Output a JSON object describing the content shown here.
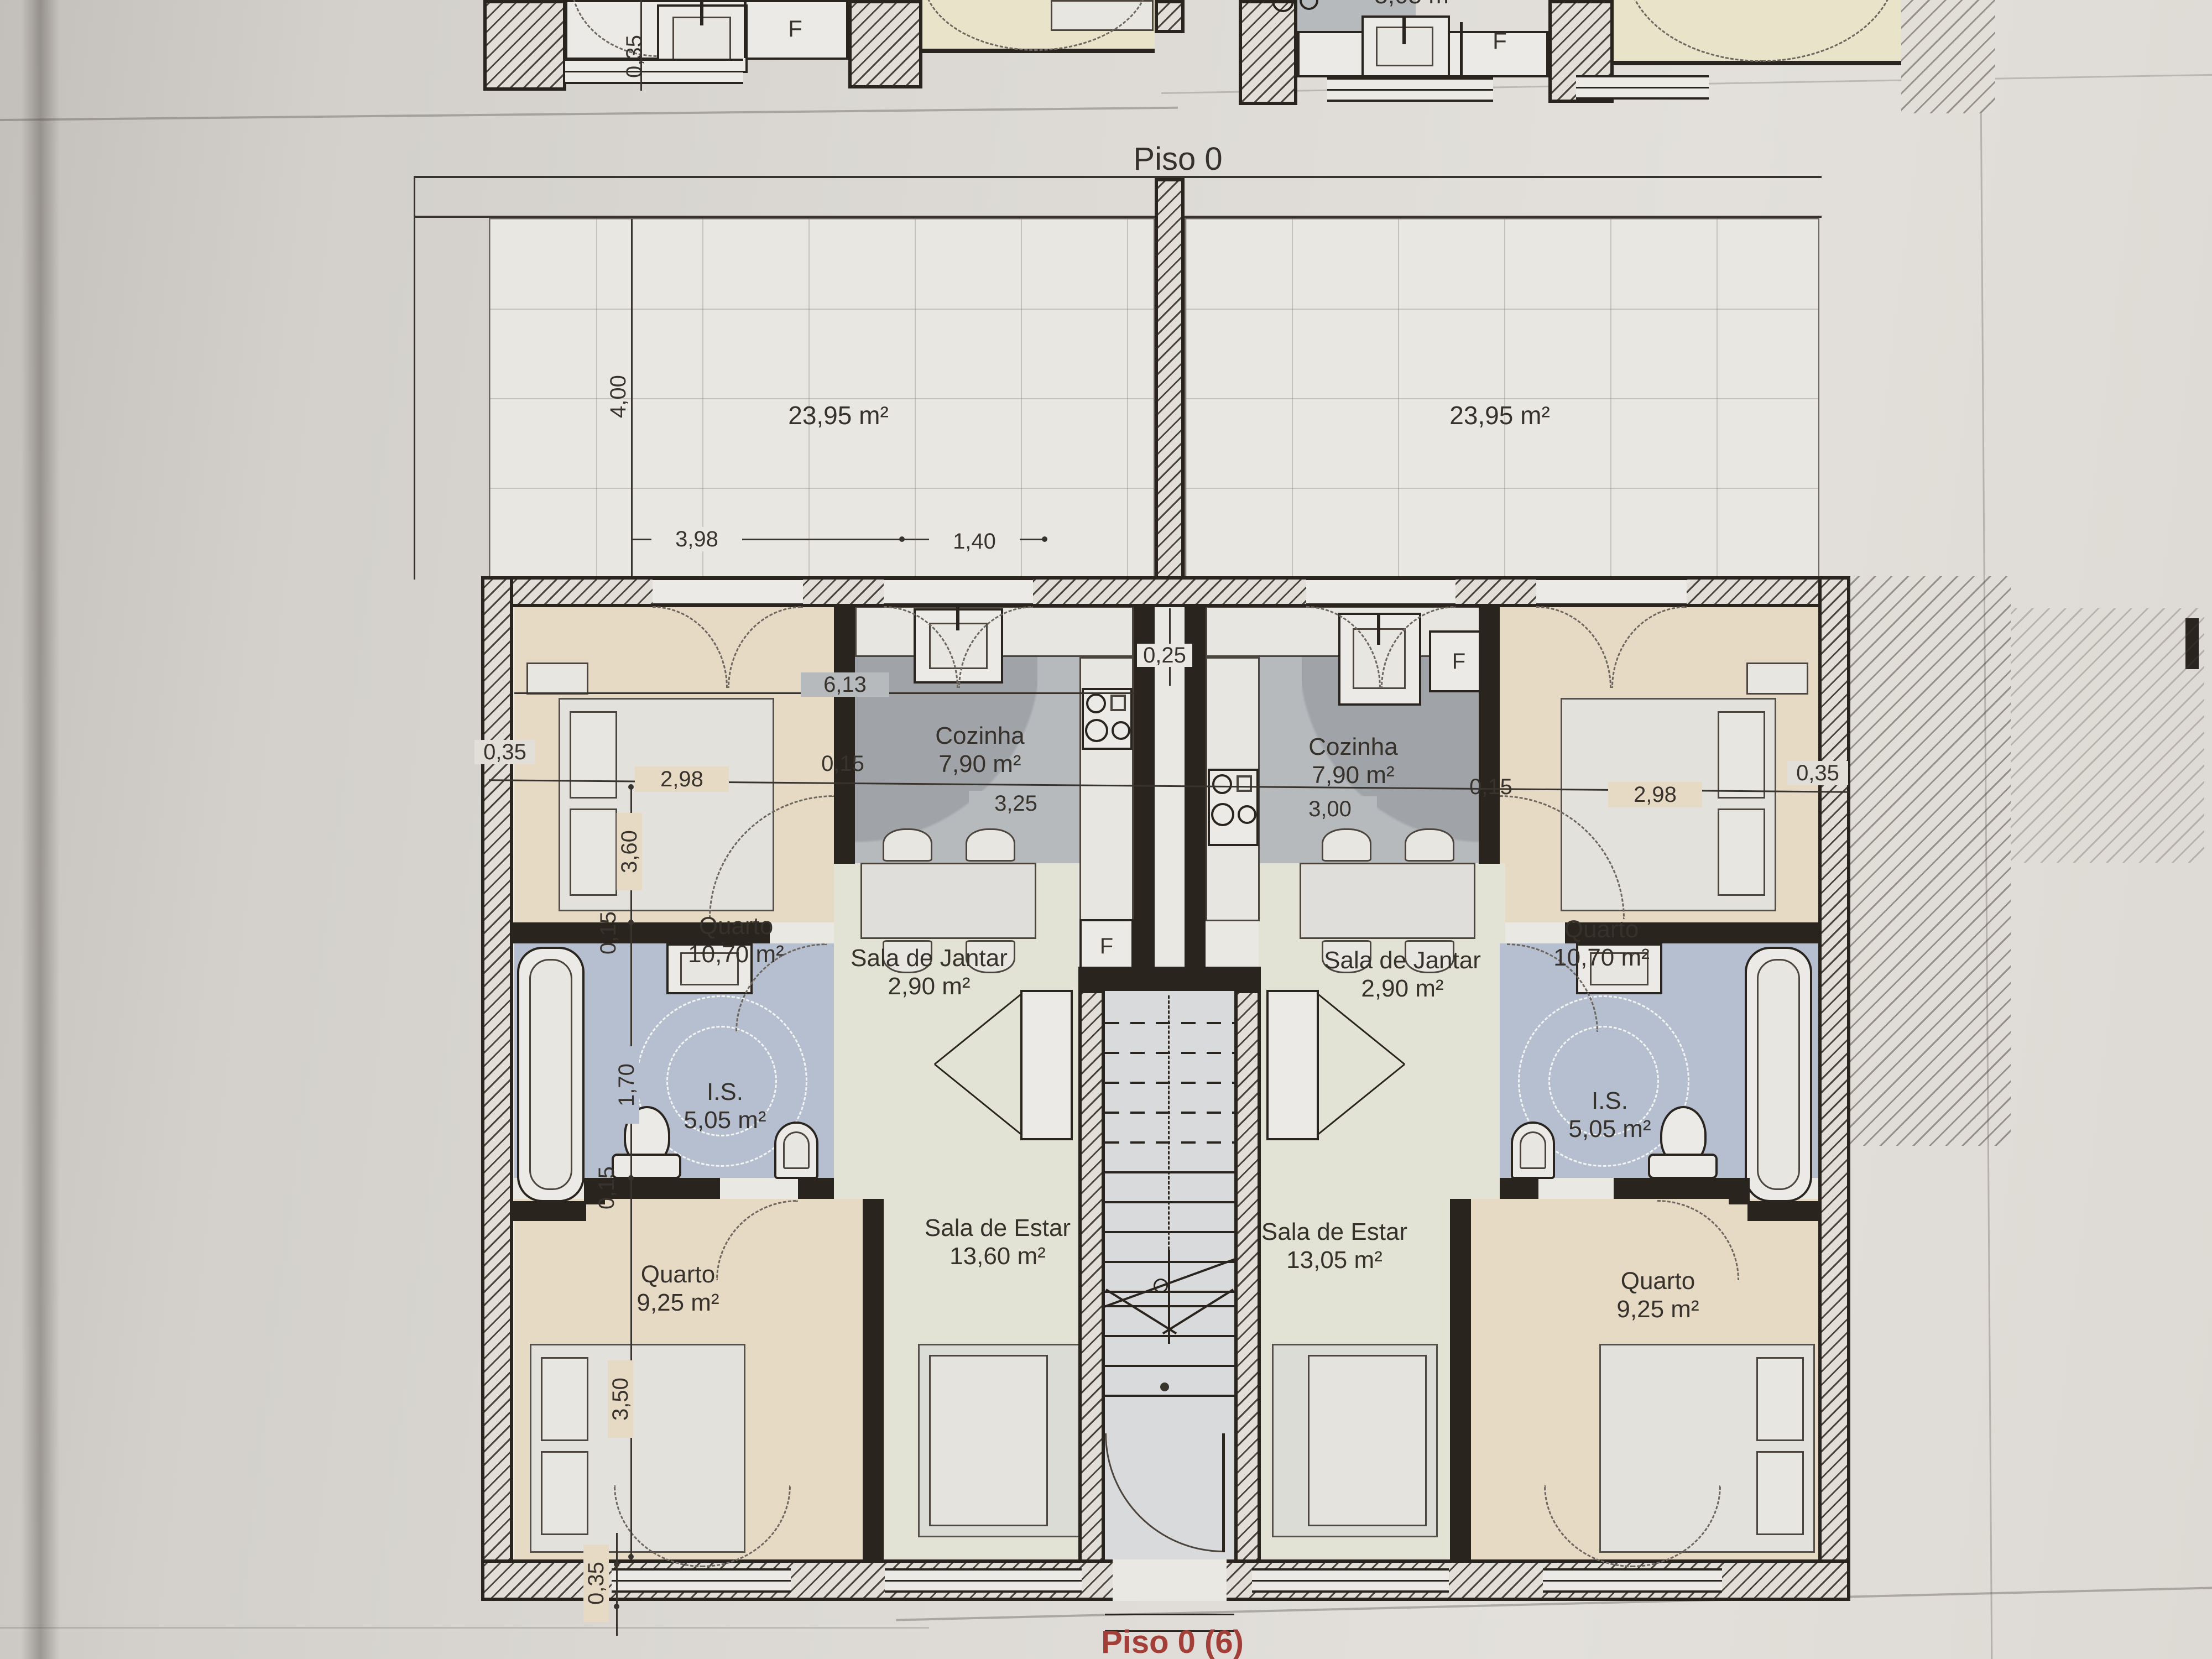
{
  "title": "Piso 0",
  "footer": "Piso 0 (6)",
  "labels": {
    "f": "F"
  },
  "top_strip": {
    "dim_wall": "0,35",
    "partial_area": "5,05 m²"
  },
  "terraces": {
    "left_area": "23,95 m²",
    "right_area": "23,95 m²"
  },
  "units": {
    "left": {
      "cozinha_name": "Cozinha",
      "cozinha_area": "7,90 m²",
      "jantar_name": "Sala de Jantar",
      "jantar_area": "2,90 m²",
      "estar_name": "Sala de Estar",
      "estar_area": "13,60 m²",
      "quarto1_name": "Quarto",
      "quarto1_area": "10,70 m²",
      "is_name": "I.S.",
      "is_area": "5,05 m²",
      "quarto2_name": "Quarto",
      "quarto2_area": "9,25 m²"
    },
    "right": {
      "cozinha_name": "Cozinha",
      "cozinha_area": "7,90 m²",
      "jantar_name": "Sala de Jantar",
      "jantar_area": "2,90 m²",
      "estar_name": "Sala de Estar",
      "estar_area": "13,05 m²",
      "quarto1_name": "Quarto",
      "quarto1_area": "10,70 m²",
      "is_name": "I.S.",
      "is_area": "5,05 m²",
      "quarto2_name": "Quarto",
      "quarto2_area": "9,25 m²"
    }
  },
  "dims": {
    "terrace_h": "4,00",
    "terrace_w1": "3,98",
    "terrace_w2": "1,40",
    "wall_l": "0,35",
    "q1l_w": "2,98",
    "p15a": "0,15",
    "unit_w": "6,13",
    "koz_l": "3,25",
    "divider": "0,25",
    "koz_r": "3,00",
    "p15b": "0,15",
    "q1r_w": "2,98",
    "wall_r": "0,35",
    "q1_h": "3,60",
    "p15c": "0,15",
    "is_h": "1,70",
    "p15d": "0,15",
    "q2_h": "3,50",
    "wall_b": "0,35"
  }
}
